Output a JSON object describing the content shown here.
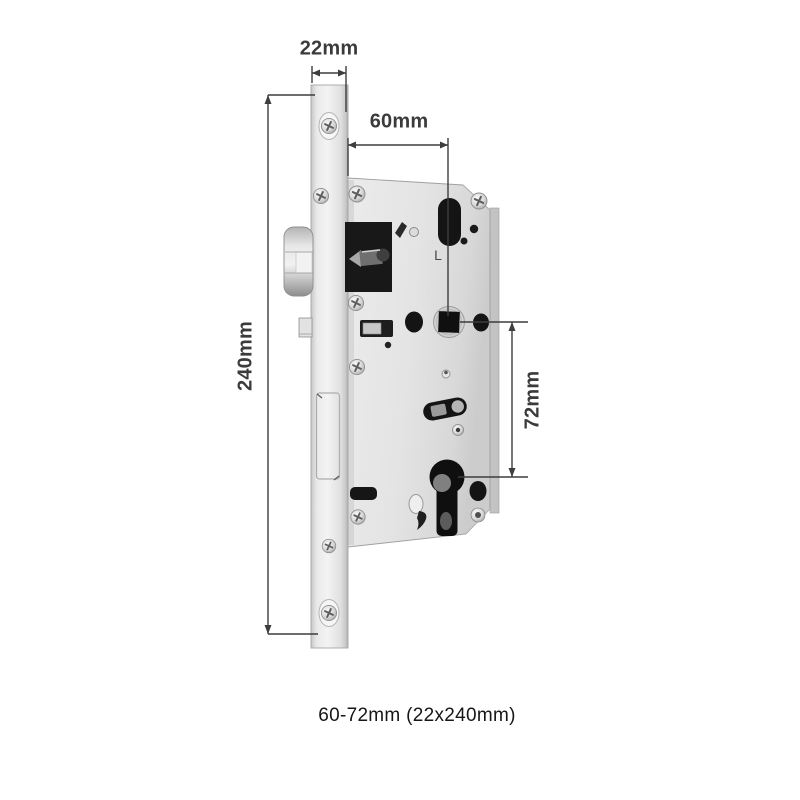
{
  "diagram": {
    "caption": "60-72mm (22x240mm)",
    "dim_faceplate_width": "22mm",
    "dim_backset": "60mm",
    "dim_faceplate_height": "240mm",
    "dim_center_distance": "72mm",
    "stamp_handing": "L",
    "colors": {
      "background": "#ffffff",
      "metal_light": "#f1f1f1",
      "metal_mid": "#d9d9d9",
      "hole_dark": "#141414",
      "dimension_line": "#3d3d3d",
      "label_text": "#3b3b3b",
      "caption_text": "#161616"
    }
  }
}
